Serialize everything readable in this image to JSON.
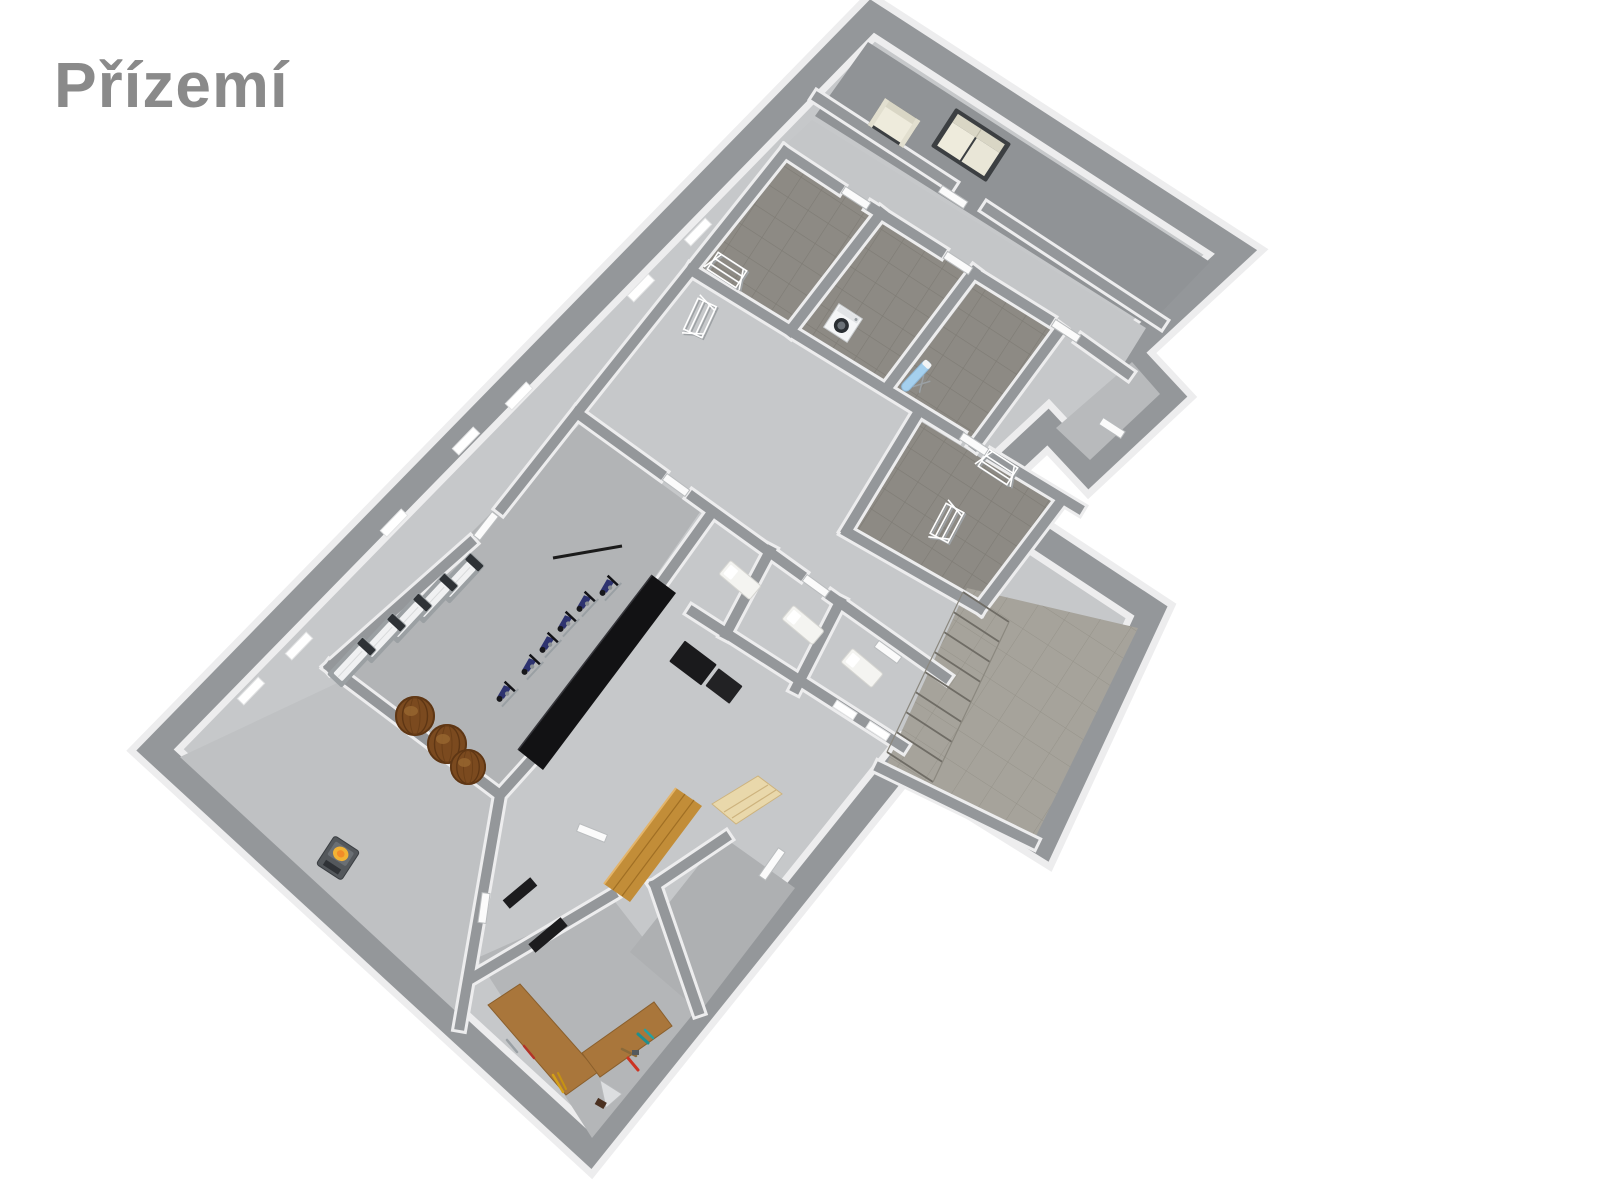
{
  "canvas": {
    "width": 1600,
    "height": 1200,
    "background": "#ffffff"
  },
  "title": {
    "text": "Přízemí"
  },
  "colors": {
    "title-color": "#8a8a8a",
    "wall": "#94979a",
    "wall-face": "#ededee",
    "floor-base": "#c6c8ca",
    "floor-living": "#909396",
    "floor-hall": "#c4c6c8",
    "tile-dark": "#8d8a84",
    "tile-grout": "#7e7b74",
    "floor-gym": "#b2b4b6",
    "floor-cellar": "#bfc1c3",
    "floor-workshop": "#b4b6b8",
    "floor-r1": "#aeb0b2",
    "floor-stairs": "#a6a39b",
    "stairs-grout": "#96938a",
    "floor-porch": "#b8babc",
    "cream": "#eeebdc",
    "sofa-frame": "#3c3f42",
    "ironing": "#a5d0ee",
    "barrel": "#7b4a1f",
    "cabinet": "#121214",
    "fire": "#f2b234",
    "wood-bench": "#a9763b",
    "sauna-wood": "#c28d38",
    "sauna-bench": "#e9d8ab"
  },
  "plan": {
    "kind": "3d-isometric-floor-plan",
    "floor_label": "Přízemí",
    "rooms": [
      {
        "id": "living-area",
        "label": "living area with sofas"
      },
      {
        "id": "hallway",
        "label": "hallway"
      },
      {
        "id": "drying-room-1",
        "label": "drying room (tiled)"
      },
      {
        "id": "laundry-room",
        "label": "laundry room"
      },
      {
        "id": "ironing-room",
        "label": "ironing room"
      },
      {
        "id": "drying-room-2",
        "label": "second drying room"
      },
      {
        "id": "corridor",
        "label": "corridor"
      },
      {
        "id": "gym",
        "label": "gym / fitness room"
      },
      {
        "id": "shower-cubicles",
        "label": "three cubicles with white trays"
      },
      {
        "id": "sauna",
        "label": "sauna with wood panelling"
      },
      {
        "id": "cellar-with-stove",
        "label": "cellar room with wood stove"
      },
      {
        "id": "workshop",
        "label": "workshop with L-shaped bench"
      },
      {
        "id": "storage-room",
        "label": "small storage room"
      },
      {
        "id": "staircase-hall",
        "label": "staircase hall"
      },
      {
        "id": "entrance-porch",
        "label": "entrance porch"
      }
    ],
    "furniture": [
      {
        "id": "armchair",
        "label": "cream armchair",
        "count": 1
      },
      {
        "id": "sofa",
        "label": "cream two-seat sofa with dark frame",
        "count": 1
      },
      {
        "id": "washing-machine",
        "label": "washing machine",
        "count": 1
      },
      {
        "id": "ironing-board",
        "label": "blue ironing board",
        "count": 1
      },
      {
        "id": "drying-rack",
        "label": "white wire drying rack",
        "count": 4
      },
      {
        "id": "treadmill",
        "label": "treadmill",
        "count": 5
      },
      {
        "id": "exercise-bike",
        "label": "exercise bike",
        "count": 6
      },
      {
        "id": "gym-cabinet",
        "label": "long black wall cabinet",
        "count": 1
      },
      {
        "id": "storage-box",
        "label": "black storage box",
        "count": 2
      },
      {
        "id": "wine-barrel",
        "label": "wooden wine barrel",
        "count": 3
      },
      {
        "id": "wood-stove",
        "label": "stove with fire glow",
        "count": 1
      },
      {
        "id": "workbench",
        "label": "L-shaped wooden workbench with tools",
        "count": 1
      },
      {
        "id": "sauna-bench",
        "label": "pale wood sauna bench",
        "count": 1
      },
      {
        "id": "shower-tray",
        "label": "white tray",
        "count": 3
      },
      {
        "id": "staircase",
        "label": "staircase with treads",
        "count": 1
      }
    ],
    "windows_count": 9,
    "doors_count": 13
  }
}
